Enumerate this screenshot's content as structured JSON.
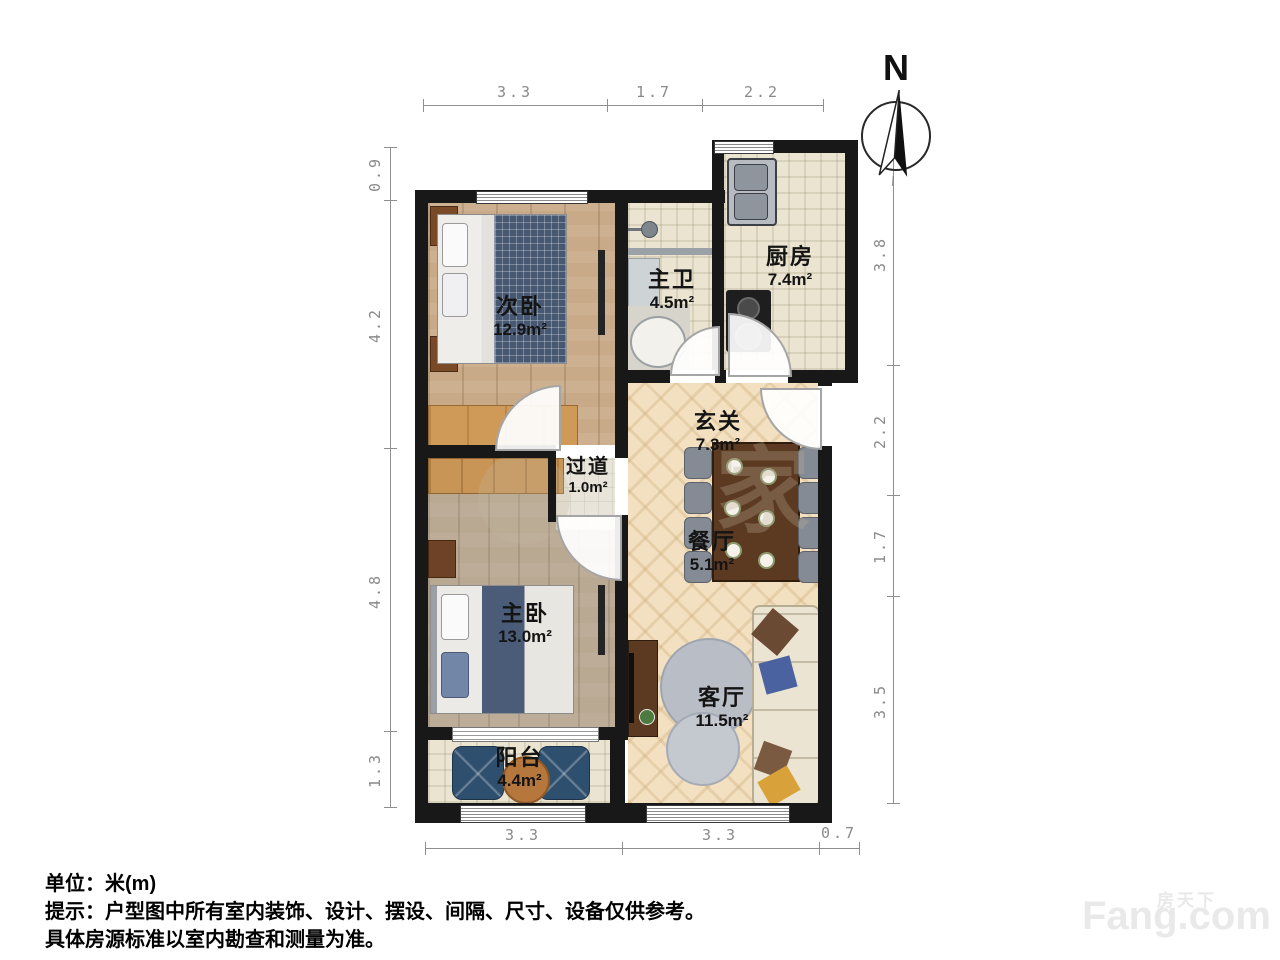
{
  "meta": {
    "unit_note": "单位：米(m)",
    "tip_line1": "提示：户型图中所有室内装饰、设计、摆设、间隔、尺寸、设备仅供参考。",
    "tip_line2": "具体房源标准以室内勘查和测量为准。"
  },
  "compass": {
    "label": "N"
  },
  "brand": {
    "cn": "房天下",
    "en": "Fang.com"
  },
  "watermark_mark": "家",
  "rooms": [
    {
      "name": "次卧",
      "area": "12.9m²"
    },
    {
      "name": "主卫",
      "area": "4.5m²"
    },
    {
      "name": "厨房",
      "area": "7.4m²"
    },
    {
      "name": "玄关",
      "area": "7.3m²"
    },
    {
      "name": "过道",
      "area": "1.0m²"
    },
    {
      "name": "餐厅",
      "area": "5.1m²"
    },
    {
      "name": "主卧",
      "area": "13.0m²"
    },
    {
      "name": "客厅",
      "area": "11.5m²"
    },
    {
      "name": "阳台",
      "area": "4.4m²"
    }
  ],
  "dimensions": {
    "top": [
      "3.3",
      "1.7",
      "2.2"
    ],
    "bottom": [
      "3.3",
      "3.3",
      "0.7"
    ],
    "left": [
      "0.9",
      "4.2",
      "4.8",
      "1.3"
    ],
    "right": [
      "3.8",
      "2.2",
      "1.7",
      "3.5"
    ]
  }
}
